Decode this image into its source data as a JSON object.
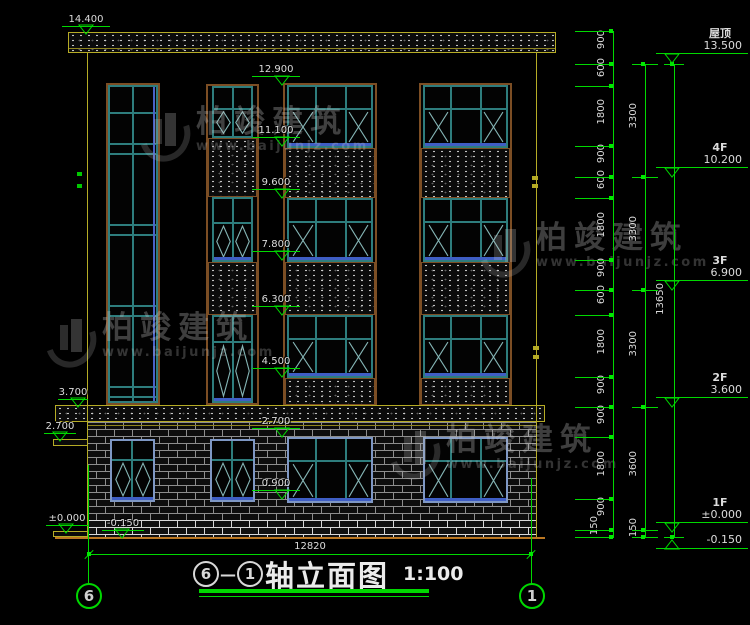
{
  "drawing": {
    "title": {
      "axis_start": "6",
      "separator": "—",
      "axis_end": "1",
      "name": "轴立面图",
      "scale": "1:100"
    },
    "overall_width_dim": "12820",
    "axis_bubble_left": "6",
    "axis_bubble_right": "1"
  },
  "levels": {
    "left": [
      "14.400",
      "3.700",
      "2.700",
      "±0.000",
      "-0.150"
    ],
    "mid": [
      "12.900",
      "11.100",
      "9.600",
      "7.800",
      "6.300",
      "4.500",
      "2.700",
      "0.900"
    ],
    "floors": [
      {
        "name": "屋顶",
        "value": "13.500"
      },
      {
        "name": "4F",
        "value": "10.200"
      },
      {
        "name": "3F",
        "value": "6.900"
      },
      {
        "name": "2F",
        "value": "3.600"
      },
      {
        "name": "1F",
        "value": "±0.000"
      },
      {
        "name": "",
        "value": "-0.150"
      }
    ]
  },
  "dims": {
    "inner": [
      "900",
      "600",
      "1800",
      "900",
      "600",
      "1800",
      "900",
      "600",
      "1800",
      "900",
      "900",
      "1800",
      "900",
      "150"
    ],
    "mid": [
      "3300",
      "3300",
      "3300",
      "3600",
      "150"
    ],
    "total": "13650"
  },
  "watermark": {
    "brand": "柏竣建筑",
    "site": "www.baijunjz.com"
  },
  "colors": {
    "dim_green": "#00d800",
    "outline_yellow": "#b5ab25",
    "window_teal": "#2e7d7d",
    "sill_blue": "#3f5ec4",
    "frame_rust": "#7c4e24",
    "ground_orange": "#bb7722"
  }
}
